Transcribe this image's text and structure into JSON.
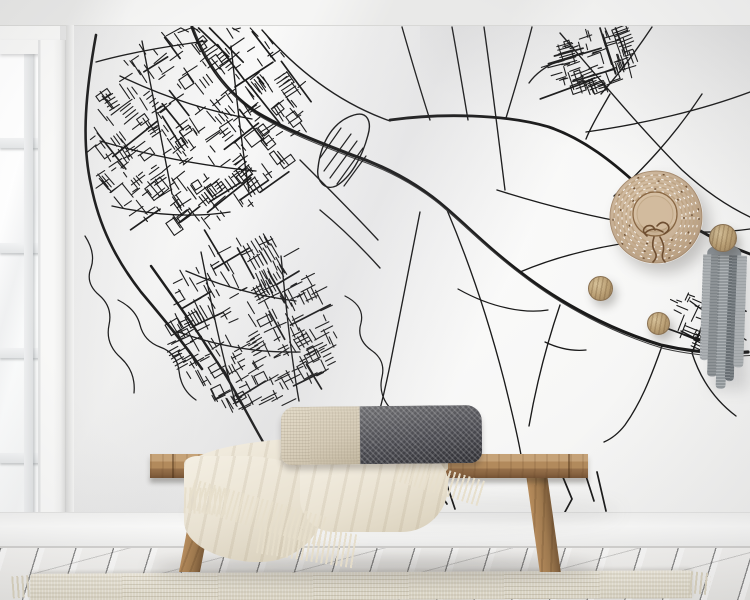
{
  "palette": {
    "wall": "#f6f6f5",
    "floor": "#f3f2f0",
    "rug": "#ebe6d8",
    "wood": "#a07a4e",
    "blanket": "#eae3d3",
    "blanketHi": "#f4efe3",
    "fringe": "#e7dfcc",
    "pilBeige": "#d6ccb8",
    "pilDark": "#4a4a50",
    "straw": "#cbb499",
    "strawHi": "#e0cdb2",
    "strawDk": "#b1977b",
    "strawRing": "#8a6844",
    "ribbon": "#6e4e31",
    "peg": "#b89d72",
    "garA": "#a9aeb1",
    "garB": "#878d91",
    "garC": "#9ba1a5",
    "garD": "#70777c",
    "mapLine": "#1a1a1a"
  },
  "map": {
    "line_color": "#1a1a1a",
    "bold_roads": [
      {
        "d": "M96,35 C86,90 81,140 91,185 C99,226 116,260 141,292 C162,317 182,341 202,369",
        "w": 2.6,
        "double": false
      },
      {
        "d": "M192,27 C205,62 226,92 256,112 C286,130 321,143 352,155 C390,168 421,186 447,209 C470,229 492,251 520,272 C560,303 611,330 661,345 C691,352 721,354 748,352",
        "w": 3.2,
        "double": true
      },
      {
        "d": "M390,120 C440,113 506,114 549,127 C584,139 613,162 641,188 C673,218 716,242 750,254",
        "w": 2.8,
        "double": false
      },
      {
        "d": "M151,266 C176,301 201,336 226,376 C244,406 256,431 269,452",
        "w": 2.4,
        "double": false
      }
    ],
    "roads": [
      "M402,27 C412,62 421,92 430,120",
      "M262,30 C300,74 342,104 390,121",
      "M452,27 C458,60 463,90 468,120",
      "M484,27 C492,84 499,142 505,190",
      "M532,27 C523,62 514,92 506,118",
      "M560,33 C602,82 642,130 682,170 C706,192 729,207 750,217",
      "M652,27 C634,54 617,76 601,94",
      "M702,94 C673,138 643,169 614,196",
      "M750,92 C702,110 643,124 586,132",
      "M497,190 C560,210 622,224 682,231 C706,233 729,232 750,229",
      "M520,272 C558,256 600,246 642,241",
      "M420,212 C410,262 400,312 391,360 C384,396 377,421 370,446",
      "M447,210 C469,262 489,322 504,380 C511,408 517,432 521,455",
      "M560,305 C546,346 536,386 529,426",
      "M662,346 C650,380 640,404 625,425 C618,434 611,439 604,442",
      "M692,353 C701,381 716,401 736,416",
      "M96,62 C132,52 170,46 206,41",
      "M112,206 C152,215 192,218 230,212",
      "M120,76 C162,96 205,111 252,119",
      "M100,141 C151,156 202,166 256,171",
      "M142,41 C152,92 162,141 172,194",
      "M231,46 C236,92 241,141 249,191",
      "M186,271 C221,286 256,296 296,301",
      "M176,331 C216,346 256,353 300,352",
      "M201,252 C211,302 221,352 236,405",
      "M281,256 C286,306 291,356 299,401",
      "M560,60 C546,66 536,73 529,83",
      "M610,94 C601,110 592,124 586,139",
      "M690,301 C709,315 728,328 746,340",
      "M681,331 C703,342 720,352 734,357",
      "M320,210 C342,228 362,248 380,268",
      "M300,160 C330,190 355,215 378,240"
    ],
    "creeks": [
      "M85,236 q11,17 6,32 q-6,15 8,27 q14,12 10,30 q-4,19 12,33 q15,14 13,35",
      "M118,300 q18,9 22,25 q4,16 20,22 q17,6 19,24 q2,19 17,29",
      "M345,296 q20,10 16,27 q-5,16 10,27 q15,10 11,27 q-4,17 8,31 q11,15 8,33",
      "M458,289 q25,14 49,19 q22,5 41,2",
      "M545,342 q21,10 41,8",
      "M688,186 q9,10 3,18 q-7,9 3,17"
    ],
    "dangles": [
      "M352,462 l14,26 l-10,22",
      "M391,466 l-6,40",
      "M399,467 l11,27 l14,17",
      "M432,481 l15,23",
      "M444,476 l11,33",
      "M560,470 l12,29 l-13,24",
      "M586,476 l8,25",
      "M597,472 l9,39"
    ],
    "hatch": {
      "outline": "M318,168 C321,141 334,121 354,115 C367,111 372,121 368,135 C362,158 350,178 336,186 C325,191 316,181 318,168 Z",
      "lines": [
        "M324,171 L351,134",
        "M330,178 L357,141",
        "M337,184 L363,148",
        "M320,158 L341,128",
        "M344,186 L366,156"
      ]
    },
    "clusters": [
      {
        "cx": 196,
        "cy": 126,
        "rx": 116,
        "ry": 96,
        "rot": -36,
        "n": 300,
        "seed": 20
      },
      {
        "cx": 252,
        "cy": 324,
        "rx": 84,
        "ry": 88,
        "rot": -28,
        "n": 220,
        "seed": 21
      },
      {
        "cx": 594,
        "cy": 60,
        "rx": 46,
        "ry": 31,
        "rot": -18,
        "n": 70,
        "seed": 22
      },
      {
        "cx": 707,
        "cy": 318,
        "rx": 38,
        "ry": 26,
        "rot": 24,
        "n": 48,
        "seed": 23
      }
    ]
  },
  "hat": {
    "ring_dash": "2.5,5.5",
    "dark_dash": "2,24"
  }
}
